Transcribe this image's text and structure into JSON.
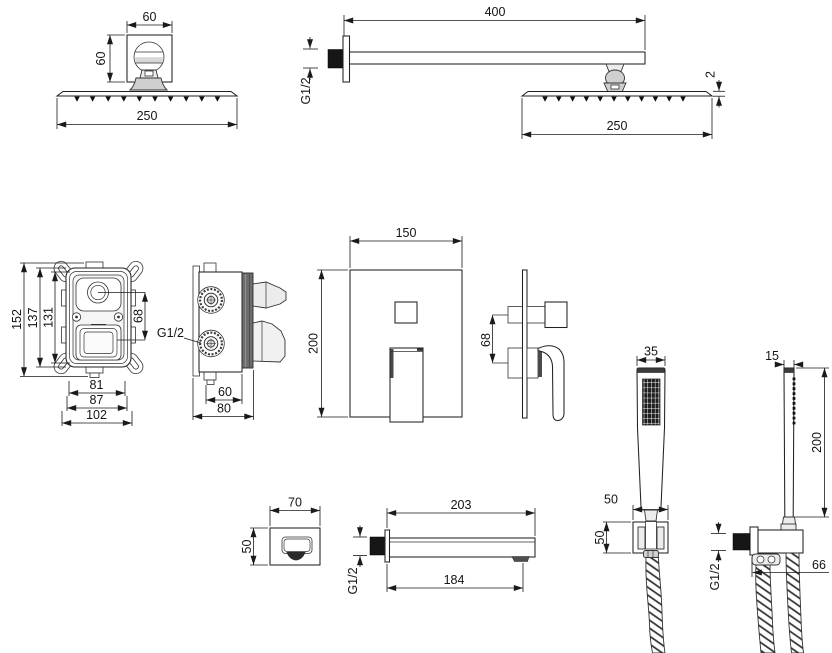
{
  "drawing": {
    "background": "#ffffff",
    "line_color": "#1a1a1a",
    "views": {
      "ceiling_shower_head_front": {
        "dims": {
          "flange_width": "60",
          "flange_height": "60",
          "head_width": "250"
        }
      },
      "wall_shower_arm_side": {
        "dims": {
          "arm_length": "400",
          "inlet_thread": "G1/2",
          "head_thickness": "2",
          "head_width": "250"
        }
      },
      "valve_body_front": {
        "dims": {
          "total_height": "152",
          "body_height": "137",
          "inner_height": "131",
          "control_offset": "68",
          "inner_width": "81",
          "body_width": "87",
          "total_width": "102"
        }
      },
      "valve_body_side": {
        "dims": {
          "port_thread": "G1/2",
          "inner_depth": "60",
          "total_depth": "80"
        }
      },
      "trim_plate_front": {
        "dims": {
          "plate_width": "150",
          "plate_height": "200"
        }
      },
      "trim_controls_side": {
        "dims": {
          "control_offset": "68"
        }
      },
      "hand_shower_front": {
        "dims": {
          "head_width": "35",
          "holder_width": "50",
          "holder_height": "50"
        }
      },
      "hand_shower_side": {
        "dims": {
          "head_depth": "15",
          "head_length": "200",
          "outlet_thread": "G1/2",
          "outlet_depth": "66"
        }
      },
      "spout_front": {
        "dims": {
          "width": "70",
          "height": "50"
        }
      },
      "spout_side": {
        "dims": {
          "total_length": "203",
          "body_length": "184",
          "inlet_thread": "G1/2"
        }
      }
    }
  }
}
